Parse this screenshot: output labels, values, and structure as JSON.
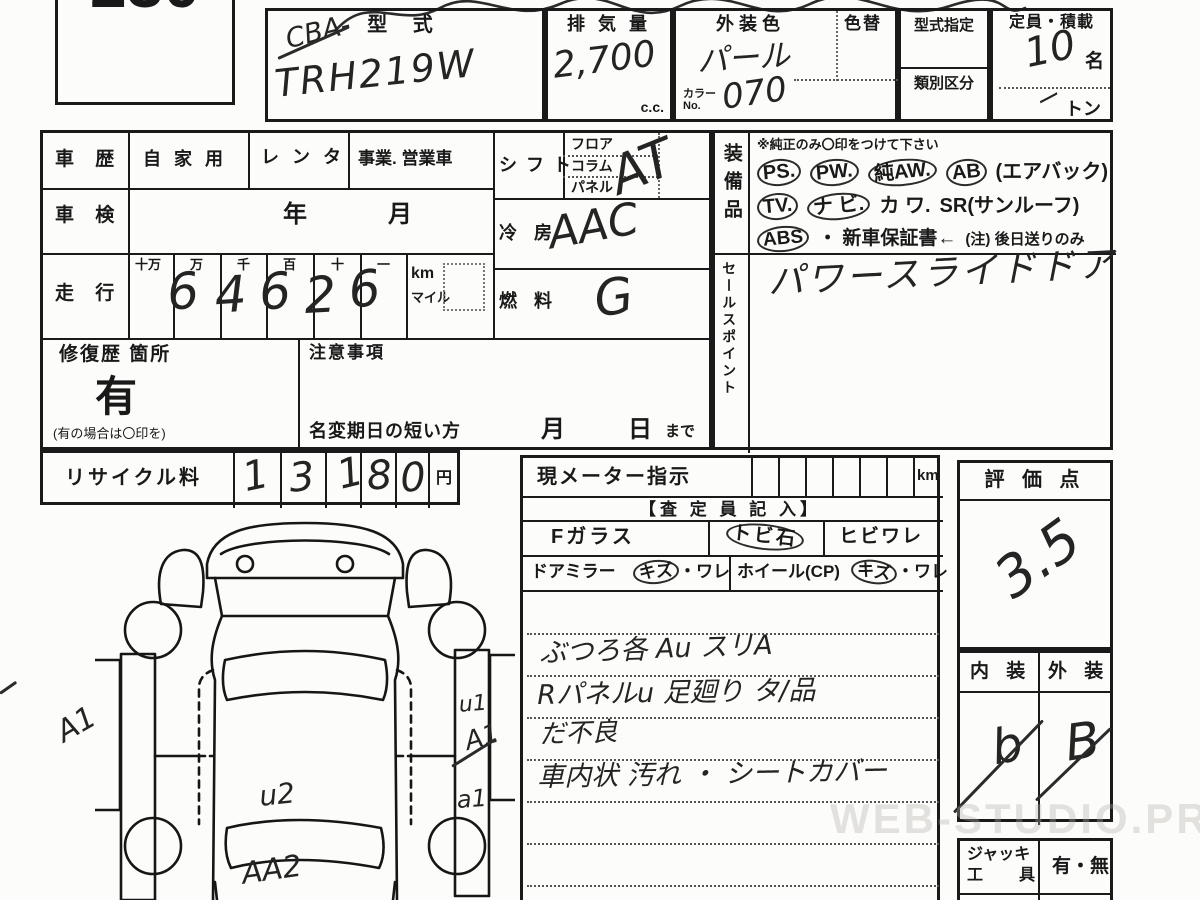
{
  "lot_number": "230",
  "top": {
    "model": {
      "label": "型    式",
      "prefix": "CBA-",
      "value": "TRH219W"
    },
    "displacement": {
      "label": "排 気 量",
      "value": "2,700",
      "unit": "c.c."
    },
    "exterior_color": {
      "label": "外装色",
      "value": "パール",
      "color_no_label": "カラー No.",
      "color_no": "070"
    },
    "color_change": {
      "label": "色替"
    },
    "model_designation": {
      "label": "型式指定"
    },
    "class_division": {
      "label": "類別区分"
    },
    "capacity": {
      "label": "定員・積載",
      "persons": "10",
      "persons_unit": "名",
      "load_dash": "ー",
      "load_unit": "トン"
    }
  },
  "history": {
    "label": "車 歴",
    "options": [
      "自 家 用",
      "レ ン タ",
      "事業. 営業車"
    ]
  },
  "shaken": {
    "label": "車 検",
    "year_label": "年",
    "month_label": "月"
  },
  "mileage": {
    "label": "走 行",
    "place_labels": [
      "十万",
      "万",
      "千",
      "百",
      "十",
      "一"
    ],
    "digits": [
      "",
      "6",
      "4",
      "6",
      "2",
      "6"
    ],
    "unit_km": "km",
    "unit_mile": "マイル"
  },
  "shift": {
    "label": "シ フ ト",
    "options": [
      "フロア",
      "コラム",
      "パネル"
    ],
    "value": "AT"
  },
  "aircon": {
    "label": "冷 房",
    "value": "AAC"
  },
  "fuel": {
    "label": "燃 料",
    "value": "G"
  },
  "repair": {
    "label": "修復歴 箇所",
    "value": "有",
    "note": "(有の場合は〇印を)"
  },
  "caution": {
    "label": "注意事項",
    "line": "名変期日の短い方",
    "month": "月",
    "day": "日",
    "suffix": "まで"
  },
  "recycle": {
    "label": "リサイクル料",
    "digits": [
      "1",
      "3",
      "1",
      "8",
      "0"
    ],
    "unit": "円"
  },
  "equipment": {
    "label": "装備品",
    "note": "※純正のみ〇印をつけて下さい",
    "rows": [
      [
        "PS.",
        "PW.",
        "純AW.",
        "AB",
        "(エアバック)"
      ],
      [
        "TV.",
        "ナ ビ.",
        "カ ワ.",
        "SR(サンルーフ)"
      ],
      [
        "ABS",
        "・ 新車保証書←",
        "(注) 後日送りのみ"
      ]
    ],
    "circled_items": [
      "PS.",
      "PW.",
      "純AW.",
      "AB",
      "TV.",
      "ナ ビ.",
      "ABS"
    ]
  },
  "sales": {
    "label": "セールスポイント",
    "value": "パワースライドドア"
  },
  "meter": {
    "label": "現メーター指示",
    "unit": "km"
  },
  "assessor": {
    "title": "【査 定 員 記 入】",
    "front_glass": {
      "label": "Fガラス",
      "stone": "トビ石",
      "crack": "ヒビワレ"
    },
    "mirror": {
      "label": "ドアミラー",
      "scratch": "キズ",
      "rest": "・ワレ"
    },
    "wheel": {
      "label": "ホイール(CP)",
      "scratch": "キズ",
      "rest": "・ワレ"
    },
    "notes": [
      "ぶつろ各  Au  スリA",
      "Rパネルu  足廻り タ/品",
      "だ不良",
      "車内状 汚れ ・ シートカバー"
    ]
  },
  "evaluation": {
    "label": "評 価 点",
    "value": "3.5"
  },
  "grades": {
    "interior_label": "内 装",
    "exterior_label": "外 装",
    "interior_value": "b",
    "exterior_value": "B"
  },
  "jack": {
    "label_line1": "ジャッキ",
    "label_line2": "工　具",
    "value": "有・無"
  },
  "diagram": {
    "annotations": {
      "left": "A1",
      "right_top": "u1",
      "right_mid": "A1",
      "right_low": "a1",
      "center": "u2",
      "bottom": "AA2"
    }
  },
  "watermark": "WEB-STUDIO.PRO"
}
